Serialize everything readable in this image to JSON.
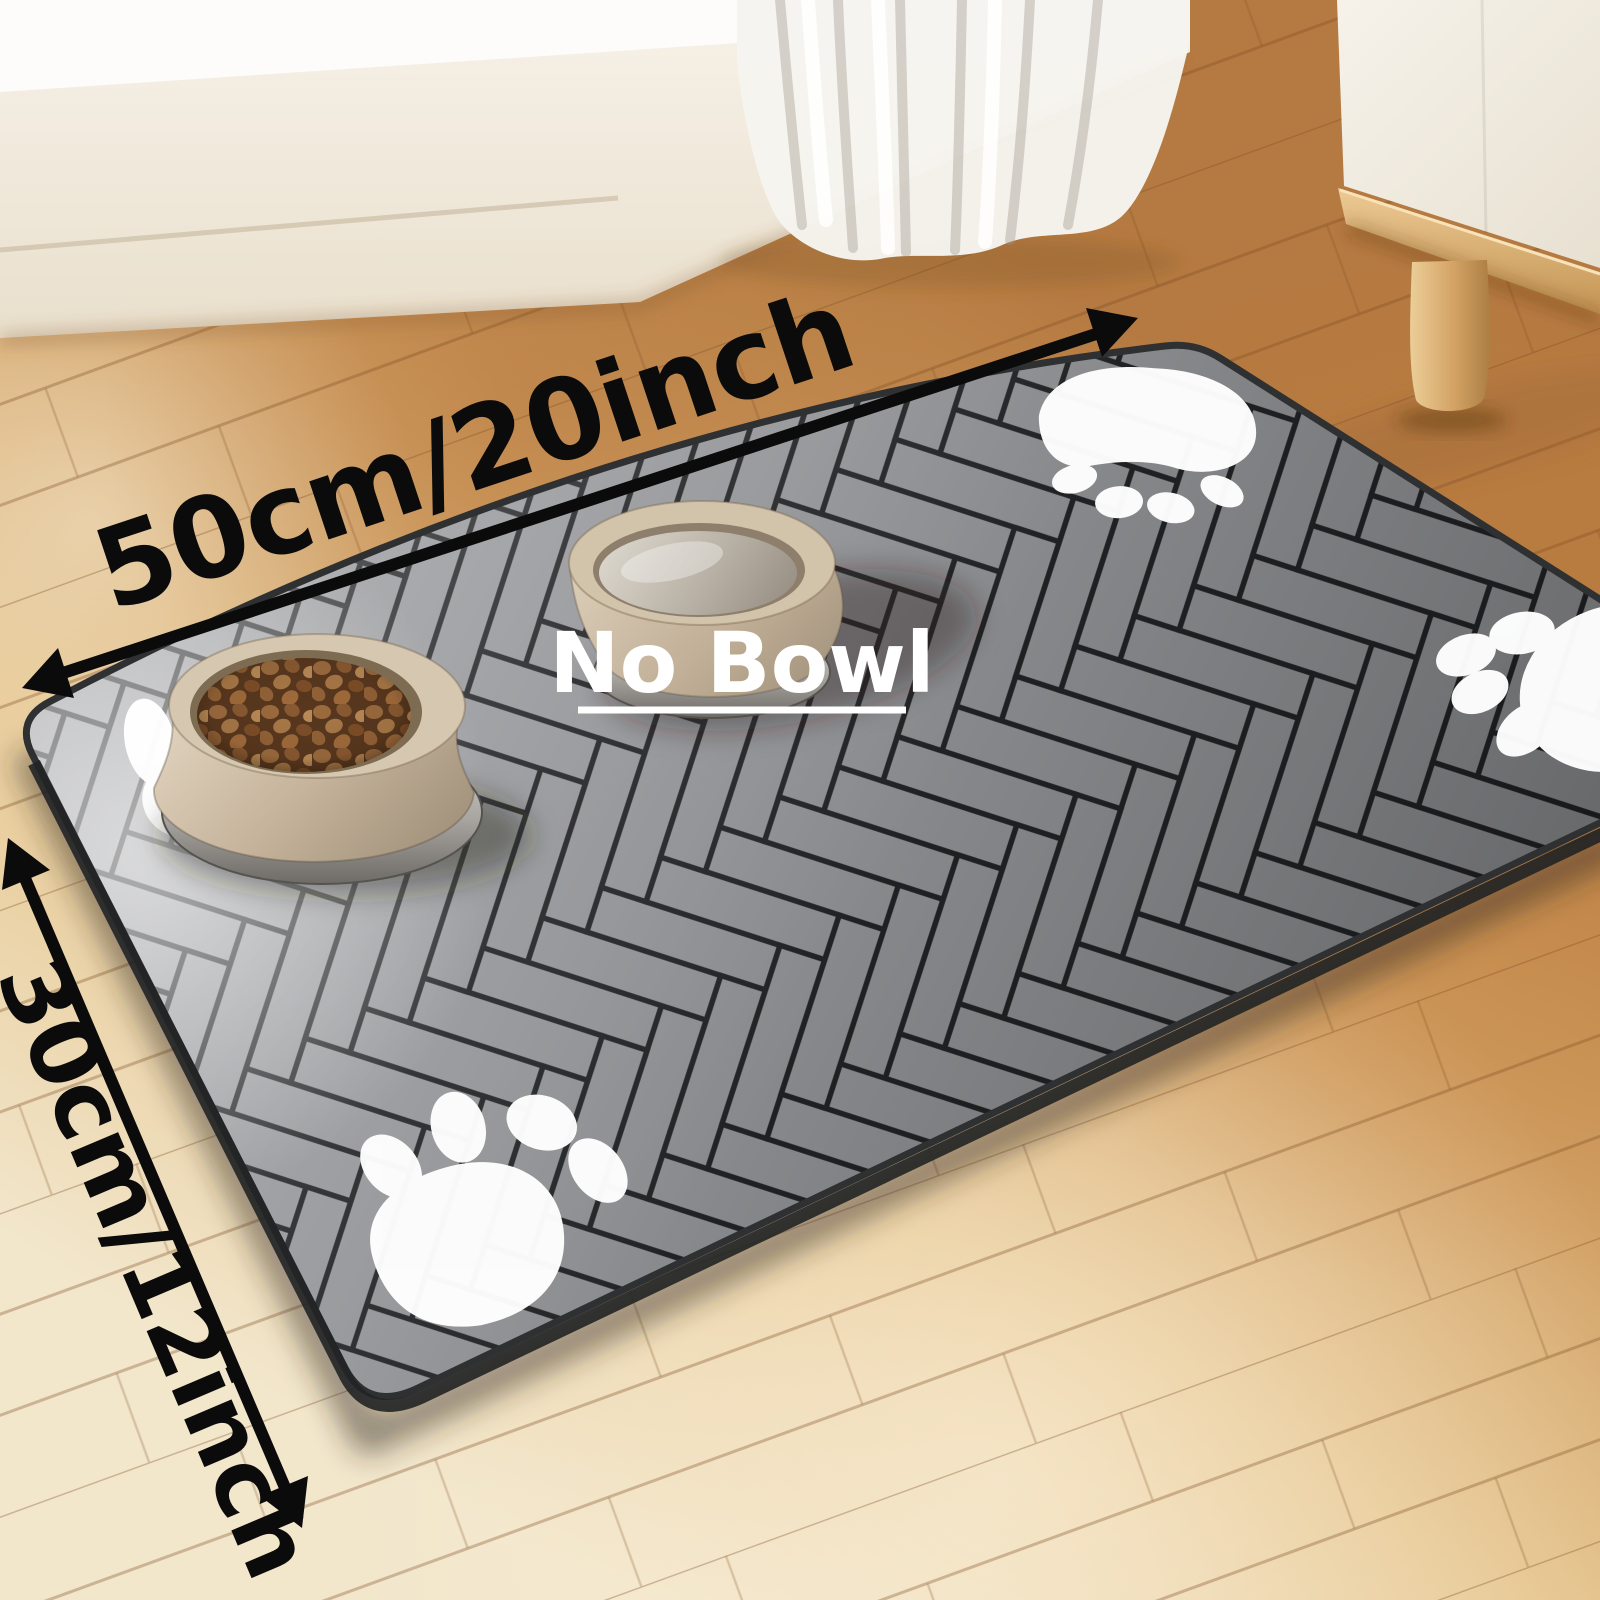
{
  "annotations": {
    "width_label": "50cm/20inch",
    "height_label": "30cm/12inch",
    "center_label": "No Bowl"
  },
  "colors": {
    "mat": "#96979a",
    "mat_seam": "#232426",
    "mat_edge": "#2e3032",
    "paw_print": "#ffffff",
    "floor_warm": "#b57a41",
    "floor_pale": "#f2e6cb",
    "wall": "#f3ecdf",
    "curtain": "#f6f4f0",
    "cabinet": "#f3eee6",
    "cabinet_leg": "#d8aa6b",
    "bowl": "#cbb9a2",
    "kibble": "#8f5f36",
    "arrow": "#0b0b0b",
    "dimension_text": "#0b0b0b",
    "no_bowl_text": "#ffffff"
  }
}
